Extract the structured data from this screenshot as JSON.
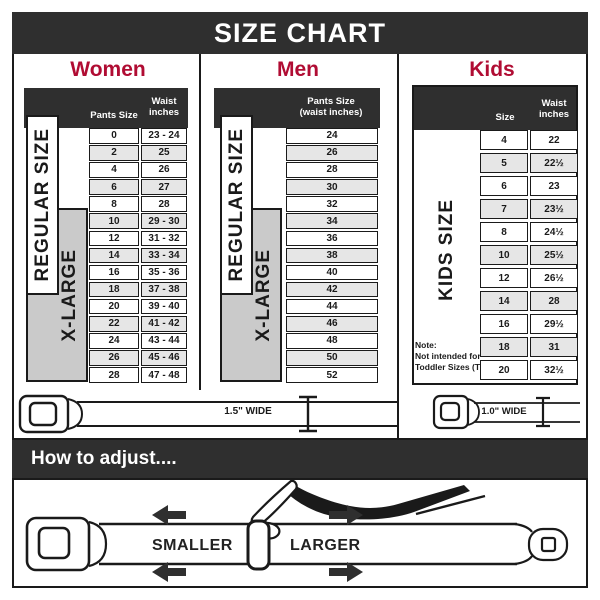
{
  "title": "SIZE CHART",
  "colors": {
    "dark": "#2f2f2f",
    "accent": "#b00c33",
    "ink": "#1a1a1a",
    "row_alt": "#e6e6e6",
    "xl_gray": "#cacaca"
  },
  "women": {
    "title": "Women",
    "label_regular": "REGULAR SIZE",
    "label_xlarge": "X-LARGE",
    "header": {
      "col1": "Pants Size",
      "col2a": "Waist",
      "col2b": "inches"
    },
    "rows": [
      [
        "0",
        "23 - 24"
      ],
      [
        "2",
        "25"
      ],
      [
        "4",
        "26"
      ],
      [
        "6",
        "27"
      ],
      [
        "8",
        "28"
      ],
      [
        "10",
        "29 - 30"
      ],
      [
        "12",
        "31 - 32"
      ],
      [
        "14",
        "33 - 34"
      ],
      [
        "16",
        "35 - 36"
      ],
      [
        "18",
        "37 - 38"
      ],
      [
        "20",
        "39 - 40"
      ],
      [
        "22",
        "41 - 42"
      ],
      [
        "24",
        "43 - 44"
      ],
      [
        "26",
        "45 - 46"
      ],
      [
        "28",
        "47 - 48"
      ]
    ]
  },
  "men": {
    "title": "Men",
    "label_regular": "REGULAR SIZE",
    "label_xlarge": "X-LARGE",
    "header": {
      "line1": "Pants Size",
      "line2": "(waist inches)"
    },
    "rows": [
      [
        "24"
      ],
      [
        "26"
      ],
      [
        "28"
      ],
      [
        "30"
      ],
      [
        "32"
      ],
      [
        "34"
      ],
      [
        "36"
      ],
      [
        "38"
      ],
      [
        "40"
      ],
      [
        "42"
      ],
      [
        "44"
      ],
      [
        "46"
      ],
      [
        "48"
      ],
      [
        "50"
      ],
      [
        "52"
      ]
    ]
  },
  "kids": {
    "title": "Kids",
    "label": "KIDS SIZE",
    "header": {
      "col1": "Size",
      "col2a": "Waist",
      "col2b": "inches"
    },
    "rows": [
      [
        "4",
        "22"
      ],
      [
        "5",
        "22½"
      ],
      [
        "6",
        "23"
      ],
      [
        "7",
        "23½"
      ],
      [
        "8",
        "24½"
      ],
      [
        "10",
        "25½"
      ],
      [
        "12",
        "26½"
      ],
      [
        "14",
        "28"
      ],
      [
        "16",
        "29½"
      ],
      [
        "18",
        "31"
      ],
      [
        "20",
        "32½"
      ]
    ],
    "note": [
      "Note:",
      "Not intended for",
      "Toddler Sizes (T)"
    ]
  },
  "belts": {
    "adult_width": "1.5\" WIDE",
    "kids_width": "1.0\" WIDE"
  },
  "adjust": {
    "bar_title": "How to adjust....",
    "smaller": "SMALLER",
    "larger": "LARGER"
  }
}
